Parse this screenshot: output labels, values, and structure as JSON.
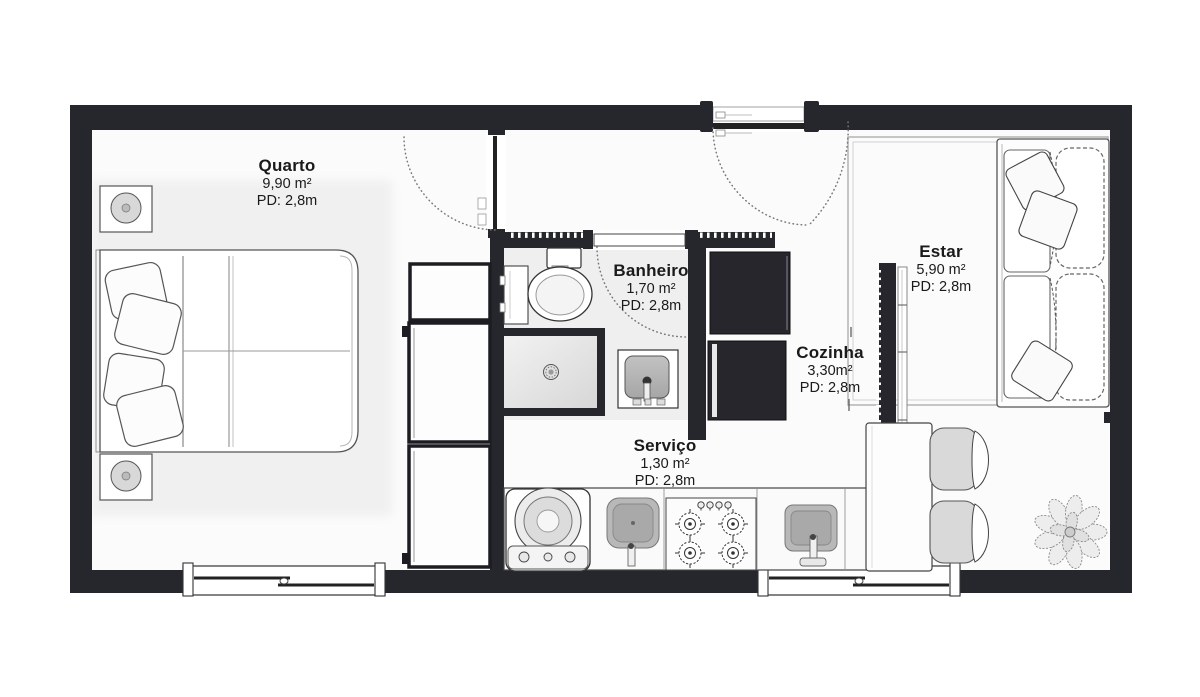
{
  "rooms": [
    {
      "id": "quarto",
      "name": "Quarto",
      "area": "9,90 m²",
      "pd": "PD: 2,8m"
    },
    {
      "id": "banheiro",
      "name": "Banheiro",
      "area": "1,70 m²",
      "pd": "PD: 2,8m"
    },
    {
      "id": "estar",
      "name": "Estar",
      "area": "5,90 m²",
      "pd": "PD: 2,8m"
    },
    {
      "id": "cozinha",
      "name": "Cozinha",
      "area": "3,30m²",
      "pd": "PD: 2,8m"
    },
    {
      "id": "servico",
      "name": "Serviço",
      "area": "1,30 m²",
      "pd": "PD: 2,8m"
    }
  ],
  "furniture": [
    {
      "id": "double-bed",
      "room": "quarto"
    },
    {
      "id": "nightstand-top",
      "room": "quarto"
    },
    {
      "id": "nightstand-bottom",
      "room": "quarto"
    },
    {
      "id": "wardrobe",
      "room": "quarto"
    },
    {
      "id": "toilet",
      "room": "banheiro"
    },
    {
      "id": "shower",
      "room": "banheiro"
    },
    {
      "id": "washbasin",
      "room": "banheiro"
    },
    {
      "id": "bath-shelf",
      "room": "banheiro"
    },
    {
      "id": "washing-machine",
      "room": "servico"
    },
    {
      "id": "laundry-sink",
      "room": "servico"
    },
    {
      "id": "cooktop",
      "room": "cozinha"
    },
    {
      "id": "kitchen-sink",
      "room": "cozinha"
    },
    {
      "id": "refrigerator",
      "room": "cozinha"
    },
    {
      "id": "cabinet",
      "room": "cozinha"
    },
    {
      "id": "divider-panel",
      "room": "cozinha"
    },
    {
      "id": "dining-table",
      "room": "cozinha"
    },
    {
      "id": "chair",
      "room": "cozinha"
    },
    {
      "id": "chair",
      "room": "cozinha"
    },
    {
      "id": "sofa",
      "room": "estar"
    },
    {
      "id": "rug",
      "room": "estar"
    },
    {
      "id": "plant",
      "room": "estar"
    }
  ],
  "openings": {
    "entry_doors": 1,
    "interior_doors": 2,
    "windows": 2
  },
  "colors": {
    "wall": "#26262d",
    "floor": "#fbfbfb",
    "room_shade": "#f1f1f1",
    "furniture_line": "#444444",
    "metal_gray": "#b8b8b8",
    "dark_appliance": "#26262c",
    "text": "#1a1a1a"
  }
}
